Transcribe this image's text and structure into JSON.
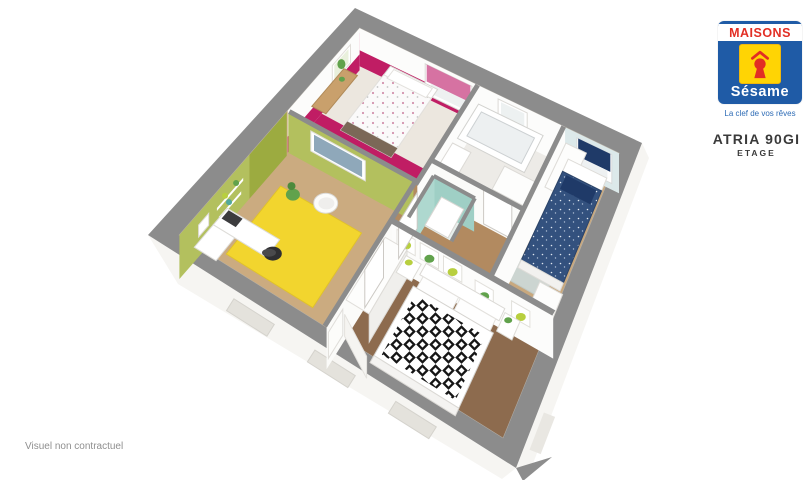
{
  "window": {
    "width": 811,
    "height": 480,
    "background": "#ffffff"
  },
  "branding": {
    "company_top": "MAISONS",
    "company_bottom": "Sésame",
    "tagline": "La clef de vos rêves",
    "model_name": "ATRIA 90GI",
    "floor_label": "ETAGE",
    "colors": {
      "logo_blue": "#1f5ba6",
      "logo_red": "#e22e24",
      "logo_yellow": "#ffd404",
      "tagline_blue": "#2e6cb6",
      "text_dark": "#3a3a3a"
    }
  },
  "footer": {
    "disclaimer": "Visuel non contractuel",
    "color": "#8f8f8f"
  },
  "floorplan": {
    "description": "3D cutaway view of the upper floor: pink child bedroom, olive-green office, bathroom, teal WC, blue child bedroom, master bedroom with black and white patterned bed, central landing and stairwell",
    "colors": {
      "wall_top": "#8c8c8c",
      "wall_white": "#fcfcfb",
      "facade": "#f6f5f2",
      "floor_base": "#f0ebe4",
      "floor_light": "#ece7df",
      "wood_light": "#c8a87e",
      "wood_mid": "#b28a60",
      "wood_dark": "#8d6b4e",
      "magenta": "#c01d64",
      "blind_pink": "#d672a2",
      "olive": "#b3c05e",
      "olive_dark": "#9cab40",
      "rug_yellow": "#f2d52e",
      "pale_blue": "#dce9ea",
      "blind_navy": "#1f3a68",
      "duvet_navy": "#33517e",
      "teal": "#9fcfc5",
      "plant_green": "#61a24c",
      "plant_lime": "#b8cf3f",
      "rug_gray": "#ccd5d1",
      "bed_base": "#7b6857",
      "desk_wood": "#c9a06c",
      "chair_black": "#2f2f31",
      "picture_blue": "#8fa8ba",
      "pattern_black": "#161616"
    }
  }
}
